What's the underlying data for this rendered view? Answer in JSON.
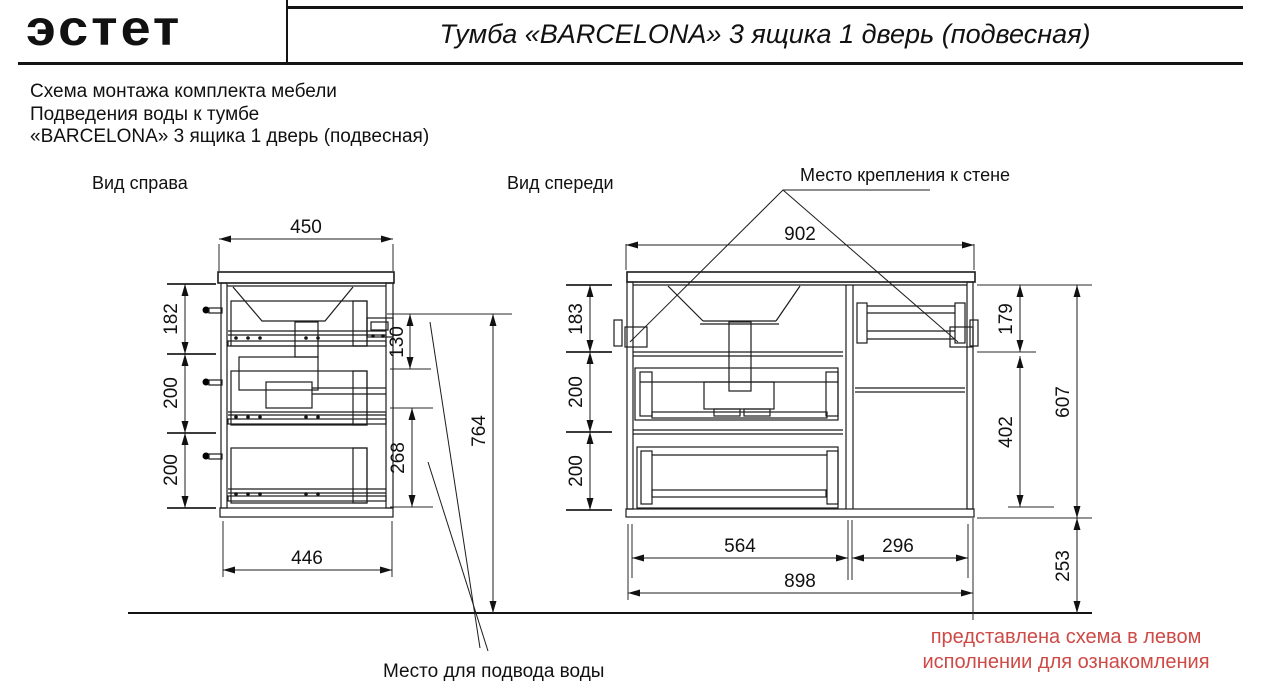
{
  "header": {
    "logo_text": "эстет",
    "title": "Тумба «BARCELONA» 3 ящика 1 дверь (подвесная)"
  },
  "intro": {
    "line1": "Схема монтажа комплекта мебели",
    "line2": "Подведения воды к тумбе",
    "line3": "«BARCELONA» 3 ящика 1 дверь (подвесная)"
  },
  "side_view": {
    "label": "Вид справа",
    "dims": {
      "top_width": "450",
      "seg1": "182",
      "seg2": "200",
      "seg3": "200",
      "tap_drop": "130",
      "drain_span": "268",
      "wall_height": "764",
      "bottom_width": "446"
    }
  },
  "front_view": {
    "label": "Вид спереди",
    "dims": {
      "top_width": "902",
      "seg1": "183",
      "seg2": "200",
      "seg3": "200",
      "right_seg1": "179",
      "right_seg2": "402",
      "body_height": "607",
      "drawer_width": "564",
      "door_width": "296",
      "bottom_width": "898",
      "floor_gap": "253"
    }
  },
  "annotations": {
    "wall_mount": "Место крепления к стене",
    "water_supply": "Место для подвода воды",
    "note_line1": "представлена схема в левом",
    "note_line2": "исполнении для ознакомления"
  },
  "colors": {
    "line": "#1c1c1c",
    "note_red": "#cd4a46",
    "siphon_gray": "#b3b3b3"
  }
}
